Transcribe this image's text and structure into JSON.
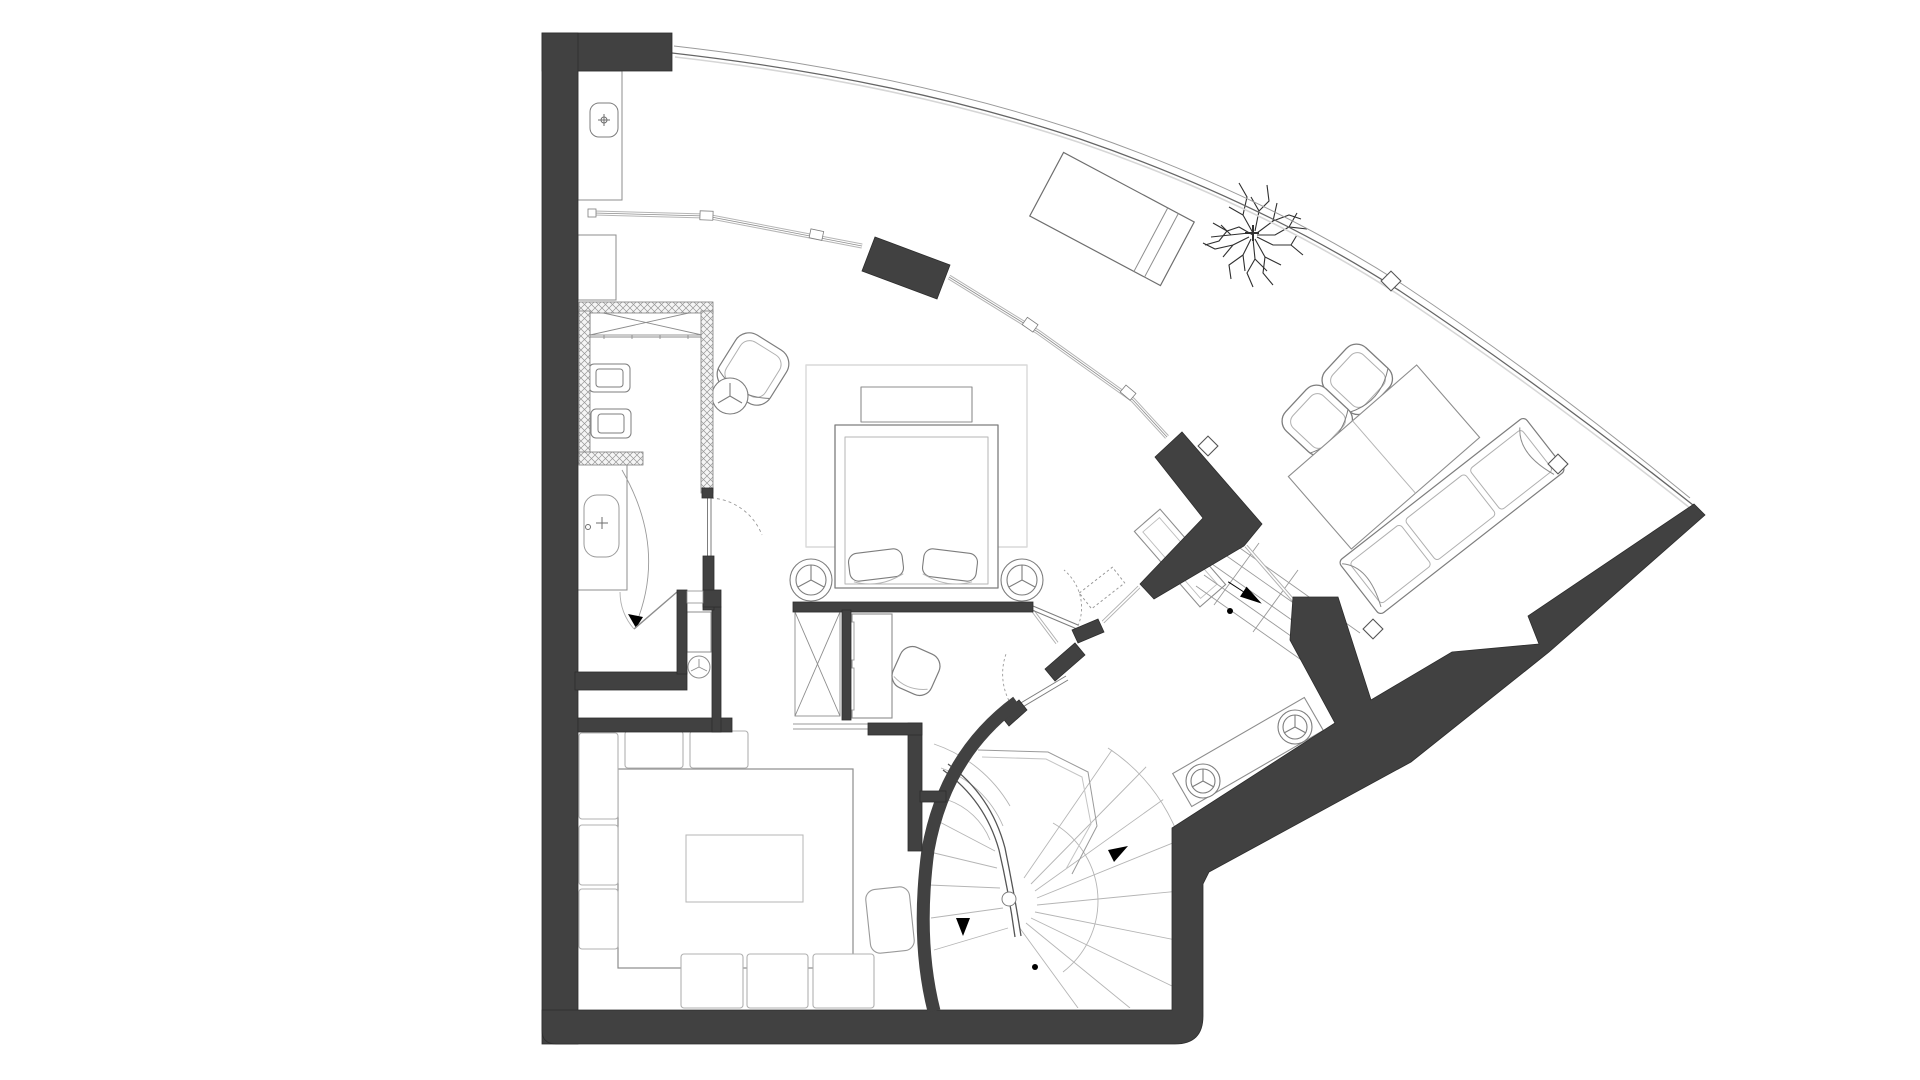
{
  "document": {
    "kind": "architectural-floor-plan",
    "description": "black-and-white apartment plan with curved glazed facade, spiral stair and fan-shaped layout",
    "visible_text_labels": []
  },
  "palette": {
    "background": "#ffffff",
    "wall_fill": "#414141",
    "wall_edge": "#2d2d2d",
    "hatch_fill": "#f5f5f5",
    "hatch_line": "#979797",
    "furniture_line": "#7d7d7d",
    "furniture_light": "#b5b5b5",
    "rug_line": "#d9d9d9",
    "glass_line": "#9a9a9a",
    "tree_line": "#303030",
    "marker_fill": "#000000"
  },
  "rooms": [
    {
      "id": "kitchen-galley",
      "furniture": [
        "counter-with-sink",
        "base-cabinet",
        "x-brace-wardrobe",
        "double-cooktop",
        "double-sink"
      ]
    },
    {
      "id": "bathroom",
      "furniture": [
        "bathtub",
        "door-swing-arc"
      ]
    },
    {
      "id": "wc",
      "furniture": [
        "door-swing-with-arrow"
      ]
    },
    {
      "id": "dressing-niche",
      "furniture": [
        "round-stool",
        "small-cabinet"
      ]
    },
    {
      "id": "bedroom",
      "furniture": [
        "area-rug",
        "headboard-bench",
        "double-bed",
        "two-foot-cushions",
        "round-side-table-left",
        "round-side-table-right",
        "dashed-overhead-shelf"
      ]
    },
    {
      "id": "study-nook",
      "furniture": [
        "built-in-desk",
        "desk-chair",
        "x-brace-wardrobe"
      ]
    },
    {
      "id": "sitting-corner",
      "furniture": [
        "armchair",
        "round-side-table"
      ]
    },
    {
      "id": "dining-room",
      "furniture": [
        "large-table",
        "table-inlay",
        "eight-chairs"
      ]
    },
    {
      "id": "hallway",
      "furniture": [
        "console-table",
        "entry-ramp-with-arrow",
        "two-swing-doors"
      ]
    },
    {
      "id": "lounge",
      "furniture": [
        "armchair-pair",
        "rectangular-table",
        "sofa"
      ]
    },
    {
      "id": "winter-garden-terrace",
      "furniture": [
        "chaise-longue",
        "tree"
      ]
    },
    {
      "id": "stair-hall",
      "furniture": [
        "bench-console",
        "two-round-stools"
      ]
    },
    {
      "id": "spiral-staircase",
      "furniture": [
        "radial-treads",
        "handrail",
        "up-arrow",
        "down-arrow",
        "newel-post"
      ]
    }
  ],
  "counts": {
    "round_stools": 6,
    "column_marker_diamonds": 4,
    "door_swings": 5,
    "direction_arrows": 4
  }
}
